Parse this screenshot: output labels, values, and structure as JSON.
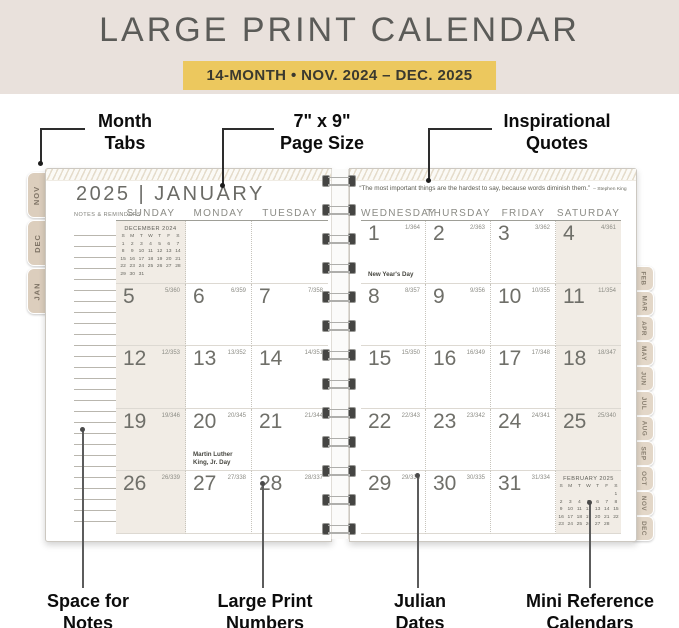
{
  "header": {
    "title": "LARGE PRINT CALENDAR",
    "banner": "14-MONTH • NOV. 2024 – DEC. 2025"
  },
  "colors": {
    "header_bg": "#e9e1dc",
    "banner_bg": "#ecc85e",
    "tab_bg": "#dccebd",
    "weekend_shade": "#f1ece5"
  },
  "callouts": {
    "top": [
      {
        "id": "month-tabs",
        "lines": [
          "Month",
          "Tabs"
        ]
      },
      {
        "id": "page-size",
        "lines": [
          "7\" x 9\"",
          "Page Size"
        ]
      },
      {
        "id": "inspirational-quotes",
        "lines": [
          "Inspirational",
          "Quotes"
        ]
      }
    ],
    "bottom": [
      {
        "id": "space-for-notes",
        "lines": [
          "Space for",
          "Notes"
        ]
      },
      {
        "id": "large-print-numbers",
        "lines": [
          "Large Print",
          "Numbers"
        ]
      },
      {
        "id": "julian-dates",
        "lines": [
          "Julian",
          "Dates"
        ]
      },
      {
        "id": "mini-reference-calendars",
        "lines": [
          "Mini Reference",
          "Calendars"
        ]
      }
    ]
  },
  "left_tabs": [
    "NOV",
    "DEC",
    "JAN"
  ],
  "right_tabs": [
    "FEB",
    "MAR",
    "APR",
    "MAY",
    "JUN",
    "JUL",
    "AUG",
    "SEP",
    "OCT",
    "NOV",
    "DEC"
  ],
  "left_page": {
    "title": "2025 | JANUARY",
    "notes_label": "NOTES & REMINDERS",
    "day_headers": [
      "SUNDAY",
      "MONDAY",
      "TUESDAY"
    ],
    "shaded_column": 0,
    "rows": [
      [
        {
          "mini": "december"
        },
        {},
        {}
      ],
      [
        {
          "day": "5",
          "julian": "5/360"
        },
        {
          "day": "6",
          "julian": "6/359"
        },
        {
          "day": "7",
          "julian": "7/358"
        }
      ],
      [
        {
          "day": "12",
          "julian": "12/353"
        },
        {
          "day": "13",
          "julian": "13/352"
        },
        {
          "day": "14",
          "julian": "14/351"
        }
      ],
      [
        {
          "day": "19",
          "julian": "19/346"
        },
        {
          "day": "20",
          "julian": "20/345",
          "note": "Martin Luther King, Jr. Day"
        },
        {
          "day": "21",
          "julian": "21/344"
        }
      ],
      [
        {
          "day": "26",
          "julian": "26/339"
        },
        {
          "day": "27",
          "julian": "27/338"
        },
        {
          "day": "28",
          "julian": "28/337"
        }
      ]
    ]
  },
  "right_page": {
    "quote": "“The most important things are the hardest to say, because words diminish them.”",
    "quote_attribution": "– Stephen King",
    "day_headers": [
      "WEDNESDAY",
      "THURSDAY",
      "FRIDAY",
      "SATURDAY"
    ],
    "shaded_column": 3,
    "rows": [
      [
        {
          "day": "1",
          "julian": "1/364",
          "note": "New Year's Day"
        },
        {
          "day": "2",
          "julian": "2/363"
        },
        {
          "day": "3",
          "julian": "3/362"
        },
        {
          "day": "4",
          "julian": "4/361"
        }
      ],
      [
        {
          "day": "8",
          "julian": "8/357"
        },
        {
          "day": "9",
          "julian": "9/356"
        },
        {
          "day": "10",
          "julian": "10/355"
        },
        {
          "day": "11",
          "julian": "11/354"
        }
      ],
      [
        {
          "day": "15",
          "julian": "15/350"
        },
        {
          "day": "16",
          "julian": "16/349"
        },
        {
          "day": "17",
          "julian": "17/348"
        },
        {
          "day": "18",
          "julian": "18/347"
        }
      ],
      [
        {
          "day": "22",
          "julian": "22/343"
        },
        {
          "day": "23",
          "julian": "23/342"
        },
        {
          "day": "24",
          "julian": "24/341"
        },
        {
          "day": "25",
          "julian": "25/340"
        }
      ],
      [
        {
          "day": "29",
          "julian": "29/336"
        },
        {
          "day": "30",
          "julian": "30/335"
        },
        {
          "day": "31",
          "julian": "31/334"
        },
        {
          "mini": "february"
        }
      ]
    ]
  },
  "mini_calendars": {
    "december": {
      "title": "DECEMBER 2024",
      "dow": [
        "S",
        "M",
        "T",
        "W",
        "T",
        "F",
        "S"
      ],
      "weeks": [
        [
          "1",
          "2",
          "3",
          "4",
          "5",
          "6",
          "7"
        ],
        [
          "8",
          "9",
          "10",
          "11",
          "12",
          "13",
          "14"
        ],
        [
          "15",
          "16",
          "17",
          "18",
          "19",
          "20",
          "21"
        ],
        [
          "22",
          "23",
          "24",
          "25",
          "26",
          "27",
          "28"
        ],
        [
          "29",
          "30",
          "31",
          "",
          "",
          "",
          ""
        ]
      ]
    },
    "february": {
      "title": "FEBRUARY 2025",
      "dow": [
        "S",
        "M",
        "T",
        "W",
        "T",
        "F",
        "S"
      ],
      "weeks": [
        [
          "",
          "",
          "",
          "",
          "",
          "",
          "1"
        ],
        [
          "2",
          "3",
          "4",
          "5",
          "6",
          "7",
          "8"
        ],
        [
          "9",
          "10",
          "11",
          "12",
          "13",
          "14",
          "15"
        ],
        [
          "16",
          "17",
          "18",
          "19",
          "20",
          "21",
          "22"
        ],
        [
          "23",
          "24",
          "25",
          "26",
          "27",
          "28",
          ""
        ]
      ]
    }
  }
}
